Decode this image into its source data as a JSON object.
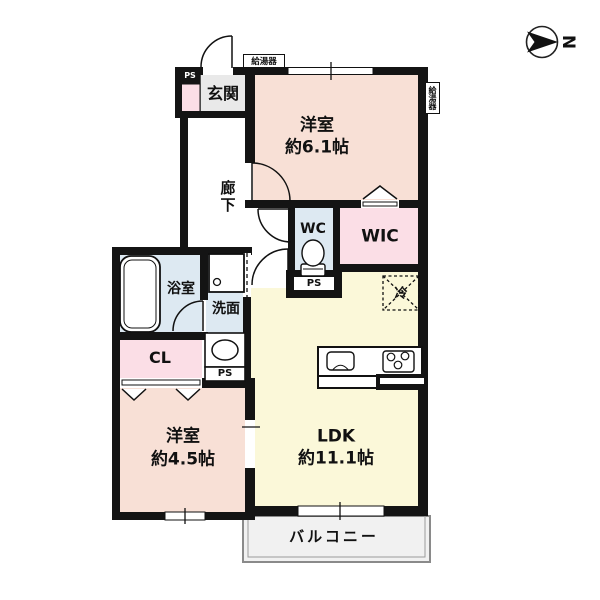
{
  "floorplan": {
    "compass": {
      "north_label": "N"
    },
    "colors": {
      "wall": "#141414",
      "bedroom_fill": "#f8e0d6",
      "closet_fill": "#fbdee6",
      "wet_fill": "#dde9f2",
      "ldk_fill": "#fbf8d9",
      "genkan_fill": "#e9e9e9",
      "balcony_fill": "#f1f1f1"
    },
    "rooms": {
      "genkan": {
        "label": "玄関"
      },
      "hallway": {
        "label": "廊下"
      },
      "bedroom1": {
        "label": "洋室",
        "size": "約6.1帖"
      },
      "wc": {
        "label": "WC"
      },
      "wic": {
        "label": "WIC"
      },
      "bathroom": {
        "label": "浴室"
      },
      "washroom": {
        "label": "洗面"
      },
      "closet": {
        "label": "CL"
      },
      "bedroom2": {
        "label": "洋室",
        "size": "約4.5帖"
      },
      "ldk": {
        "label": "LDK",
        "size": "約11.1帖"
      },
      "balcony": {
        "label": "バルコニー"
      }
    },
    "equipment": {
      "water_heater_top": "給湯器",
      "water_heater_right": "給湯器",
      "fridge": "冷",
      "ps_entry": "PS",
      "ps_wc": "PS",
      "ps_wash": "PS"
    },
    "icons": [
      "compass-north-arrow",
      "entry-door-arc",
      "bedroom1-door-arc",
      "wc-door-arc",
      "washroom-door-arc",
      "bathroom-door-arc",
      "washroom-sliding-door",
      "toilet",
      "bathtub",
      "washing-machine",
      "sink-basin",
      "kitchen-counter",
      "kitchen-sink",
      "stove-burners",
      "fridge-space",
      "window-marks",
      "wic-door-triangle",
      "closet-door-triangles"
    ]
  }
}
